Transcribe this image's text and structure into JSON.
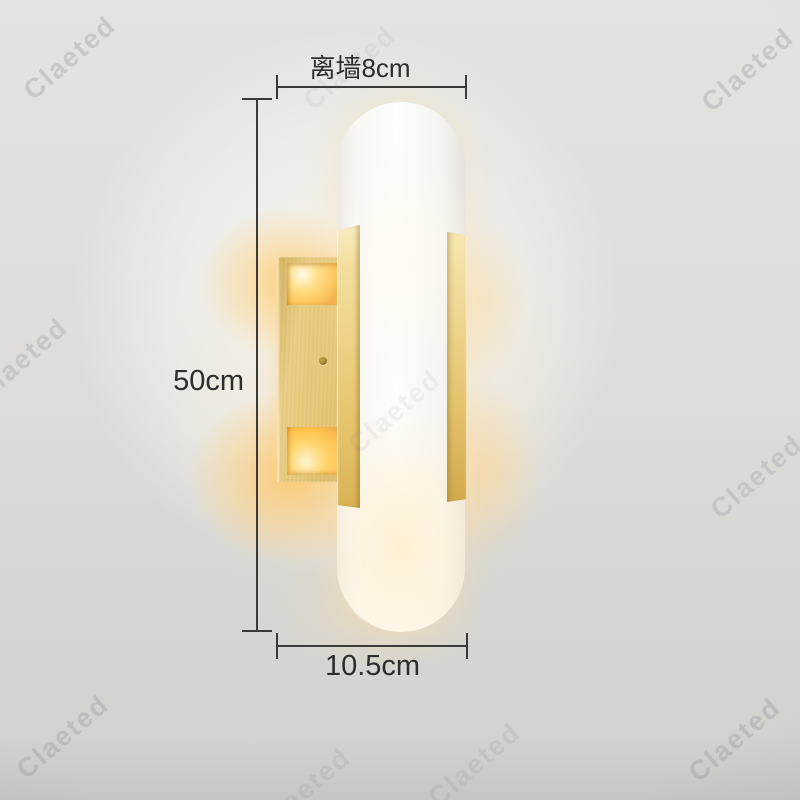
{
  "image": {
    "type": "product-photo",
    "subject": "brass wall sconce lamp with white capsule diffuser"
  },
  "watermark": {
    "text": "Claeted"
  },
  "dimensions": {
    "wall_distance_label": "离墙8cm",
    "height_label": "50cm",
    "width_label": "10.5cm"
  },
  "colors": {
    "background": "#d8d7d4",
    "background_light": "#f4f3ef",
    "brass": "#e6c878",
    "brass_dark": "#d2a94e",
    "glow_warm": "#ffd06e",
    "shade_white": "#fbfbfa",
    "dimension_line": "#3b3a38",
    "label_text": "#2e2d2b",
    "watermark_gray": "#878d94"
  }
}
